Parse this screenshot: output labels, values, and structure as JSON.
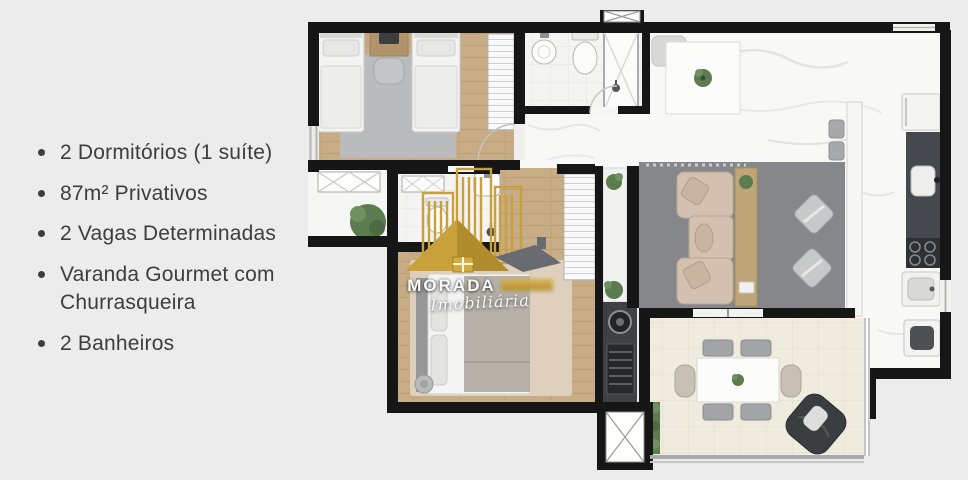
{
  "page": {
    "background_color": "#ececec",
    "width_px": 968,
    "height_px": 480
  },
  "features": {
    "items": [
      "2 Dormitórios (1 suíte)",
      "87m² Privativos",
      "2 Vagas Determinadas",
      "Varanda Gourmet com Churrasqueira",
      "2 Banheiros"
    ]
  },
  "watermark": {
    "brand": "MORADA",
    "subtitle": "Imobiliária",
    "gold_color": "#c8a13b",
    "roof_gray_color": "#686c70"
  },
  "floorplan": {
    "wall_color": "#161616",
    "wood_floor_color": "#c8ac86",
    "marble_floor_color": "#f8f8f7",
    "living_rug_color": "#85878a",
    "balcony_floor_color": "#efebdf",
    "sofa_color": "#d3c0b1",
    "plant_color": "#5c7c50",
    "counter_dark_color": "#45484c"
  }
}
